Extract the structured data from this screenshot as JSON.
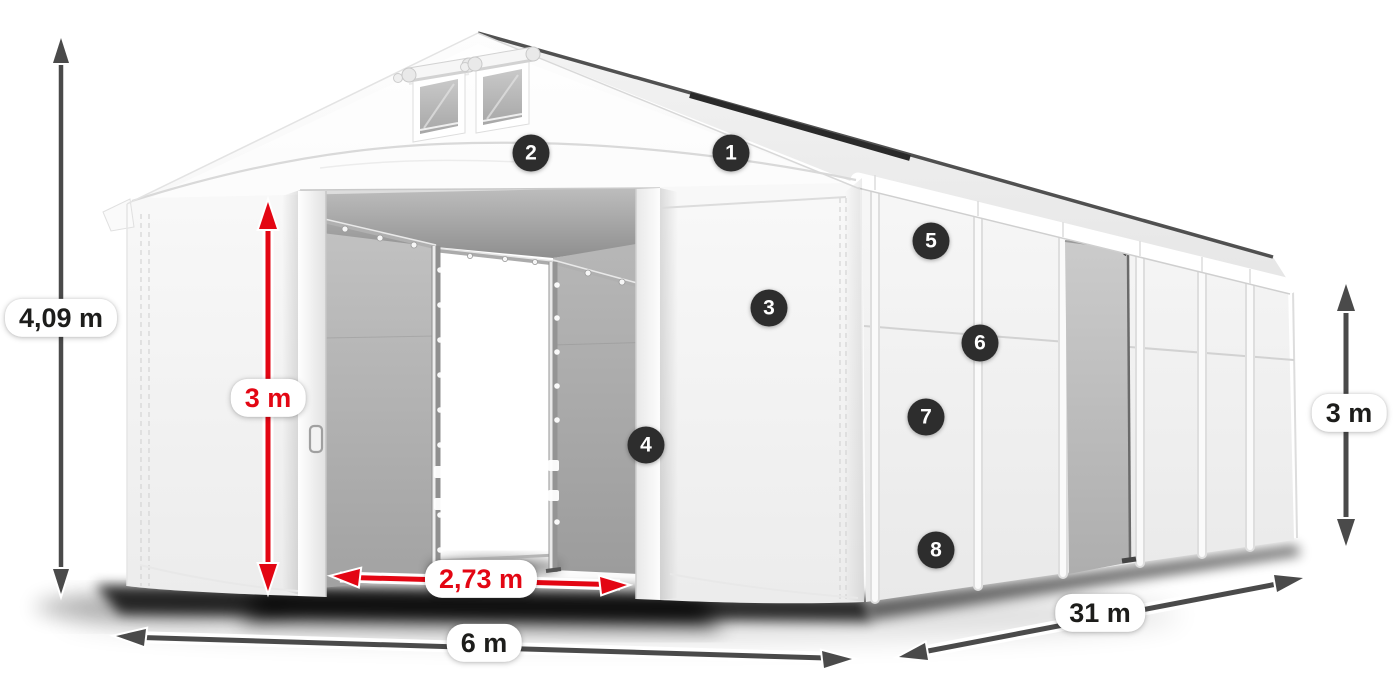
{
  "diagram": {
    "description": "Warehouse storage tent illustration with dimension annotations",
    "dimensions": {
      "total_height": "4,09 m",
      "entrance_height": "3 m",
      "entrance_width": "2,73 m",
      "front_width": "6 m",
      "side_length": "31 m",
      "side_wall_height": "3 m"
    },
    "callouts": [
      {
        "number": "1"
      },
      {
        "number": "2"
      },
      {
        "number": "3"
      },
      {
        "number": "4"
      },
      {
        "number": "5"
      },
      {
        "number": "6"
      },
      {
        "number": "7"
      },
      {
        "number": "8"
      }
    ],
    "colors": {
      "red_dimension": "#e30613",
      "dark_dimension": "#4a4a4a",
      "callout_background": "#2d2d2d",
      "label_text": "#1d1d1b"
    }
  }
}
